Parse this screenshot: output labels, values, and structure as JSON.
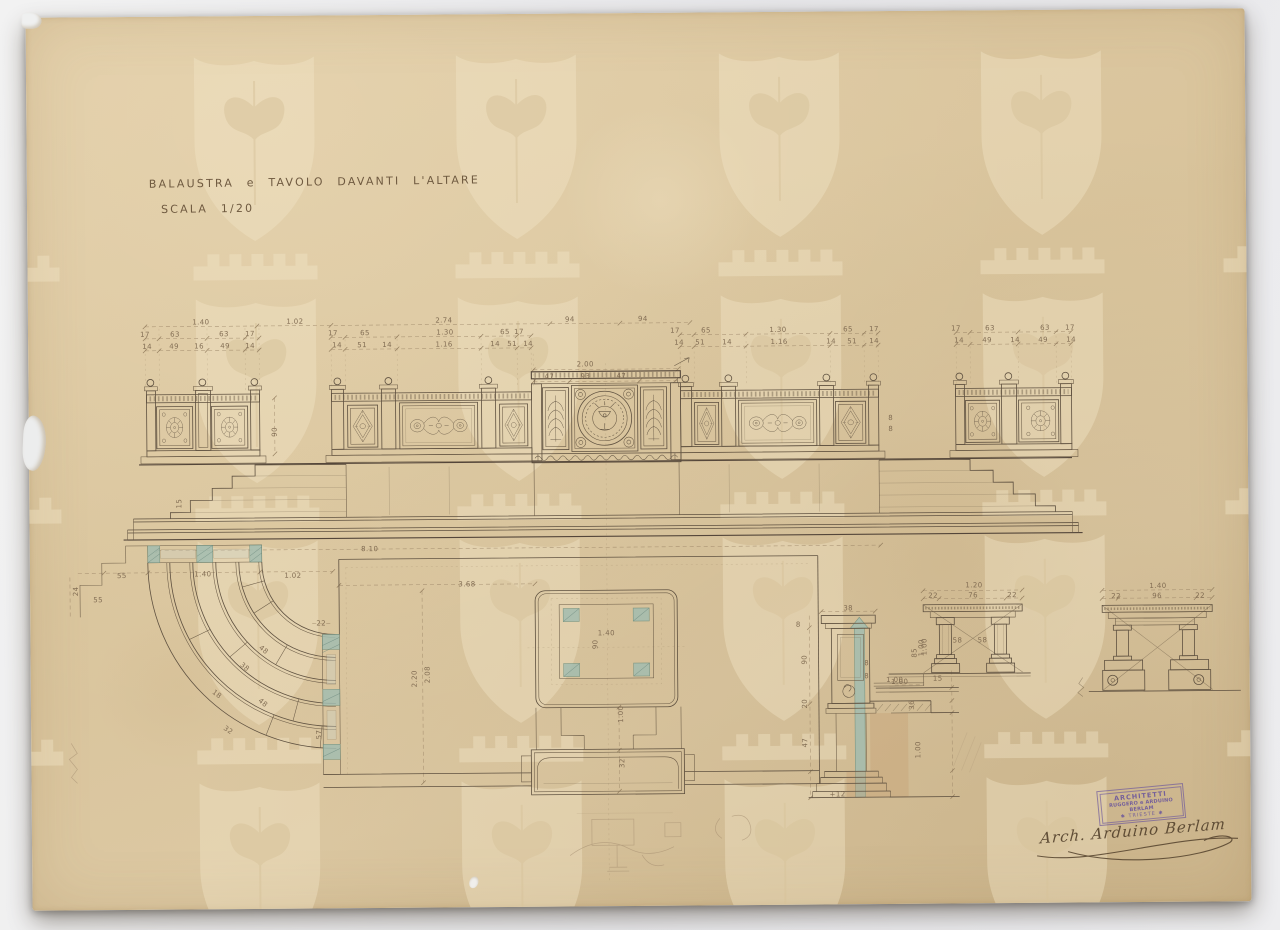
{
  "document": {
    "title": "BALAUSTRA e TAVOLO DAVANTI L'ALTARE",
    "scale": "SCALA 1/20"
  },
  "stamp": {
    "line1": "ARCHITETTI",
    "line2": "RUGGERO e ARDUINO BERLAM",
    "line3": "✱ TRIESTE ✱"
  },
  "signature": "Arch. Arduino Berlam",
  "colors": {
    "paper": "#dcc8a2",
    "ink": "#5f5140",
    "dimension_ink": "#8a735a",
    "verdigris": "#a3bdb0",
    "wash_brown": "#c3996b",
    "stamp_purple": "#6d589c",
    "backdrop": "#e9e9ec"
  },
  "annotations": [
    {
      "t": "1.40",
      "x": 173,
      "y": 306
    },
    {
      "t": "1.02",
      "x": 267,
      "y": 306
    },
    {
      "t": "2.74",
      "x": 416,
      "y": 306
    },
    {
      "t": "94",
      "x": 542,
      "y": 306
    },
    {
      "t": "94",
      "x": 615,
      "y": 306
    },
    {
      "t": "17",
      "x": 117,
      "y": 318
    },
    {
      "t": "63",
      "x": 147,
      "y": 318
    },
    {
      "t": "63",
      "x": 196,
      "y": 318
    },
    {
      "t": "17",
      "x": 222,
      "y": 318
    },
    {
      "t": "17",
      "x": 305,
      "y": 318
    },
    {
      "t": "65",
      "x": 337,
      "y": 318
    },
    {
      "t": "1.30",
      "x": 417,
      "y": 318
    },
    {
      "t": "65",
      "x": 477,
      "y": 318
    },
    {
      "t": "17",
      "x": 491,
      "y": 318
    },
    {
      "t": "17",
      "x": 647,
      "y": 318
    },
    {
      "t": "65",
      "x": 678,
      "y": 318
    },
    {
      "t": "1.30",
      "x": 750,
      "y": 318
    },
    {
      "t": "65",
      "x": 820,
      "y": 318
    },
    {
      "t": "17",
      "x": 846,
      "y": 318
    },
    {
      "t": "17",
      "x": 928,
      "y": 318
    },
    {
      "t": "63",
      "x": 962,
      "y": 318
    },
    {
      "t": "63",
      "x": 1017,
      "y": 318
    },
    {
      "t": "17",
      "x": 1042,
      "y": 318
    },
    {
      "t": "14",
      "x": 119,
      "y": 330
    },
    {
      "t": "49",
      "x": 146,
      "y": 330
    },
    {
      "t": "16",
      "x": 171,
      "y": 330
    },
    {
      "t": "49",
      "x": 197,
      "y": 330
    },
    {
      "t": "14",
      "x": 222,
      "y": 330
    },
    {
      "t": "14",
      "x": 309,
      "y": 330
    },
    {
      "t": "51",
      "x": 334,
      "y": 330
    },
    {
      "t": "14",
      "x": 359,
      "y": 330
    },
    {
      "t": "1.16",
      "x": 416,
      "y": 330
    },
    {
      "t": "14",
      "x": 467,
      "y": 330
    },
    {
      "t": "51",
      "x": 484,
      "y": 330
    },
    {
      "t": "14",
      "x": 500,
      "y": 330
    },
    {
      "t": "14",
      "x": 651,
      "y": 330
    },
    {
      "t": "51",
      "x": 672,
      "y": 330
    },
    {
      "t": "14",
      "x": 699,
      "y": 330
    },
    {
      "t": "1.16",
      "x": 751,
      "y": 330
    },
    {
      "t": "14",
      "x": 803,
      "y": 330
    },
    {
      "t": "51",
      "x": 824,
      "y": 330
    },
    {
      "t": "14",
      "x": 846,
      "y": 330
    },
    {
      "t": "14",
      "x": 931,
      "y": 330
    },
    {
      "t": "49",
      "x": 959,
      "y": 330
    },
    {
      "t": "14",
      "x": 987,
      "y": 330
    },
    {
      "t": "49",
      "x": 1015,
      "y": 330
    },
    {
      "t": "14",
      "x": 1043,
      "y": 330
    },
    {
      "t": "2.00",
      "x": 557,
      "y": 351
    },
    {
      "t": "47",
      "x": 521,
      "y": 363
    },
    {
      "t": "93",
      "x": 557,
      "y": 363
    },
    {
      "t": "47",
      "x": 593,
      "y": 363
    },
    {
      "t": "90",
      "x": 246,
      "y": 416,
      "r": -90
    },
    {
      "t": "8",
      "x": 862,
      "y": 407
    },
    {
      "t": "8",
      "x": 862,
      "y": 418
    },
    {
      "t": "15",
      "x": 150,
      "y": 487,
      "r": -90
    },
    {
      "t": "8.10",
      "x": 340,
      "y": 534
    },
    {
      "t": "55",
      "x": 92,
      "y": 559
    },
    {
      "t": "55",
      "x": 68,
      "y": 583
    },
    {
      "t": "24",
      "x": 46,
      "y": 574,
      "r": -90
    },
    {
      "t": "1.40",
      "x": 173,
      "y": 558
    },
    {
      "t": "1.02",
      "x": 263,
      "y": 560
    },
    {
      "t": "22",
      "x": 291,
      "y": 608
    },
    {
      "t": "48",
      "x": 233,
      "y": 634,
      "r": 40
    },
    {
      "t": "38",
      "x": 214,
      "y": 651,
      "r": 40
    },
    {
      "t": "18",
      "x": 186,
      "y": 678,
      "r": 38
    },
    {
      "t": "32",
      "x": 197,
      "y": 714,
      "r": 35
    },
    {
      "t": "48",
      "x": 232,
      "y": 687,
      "r": 40
    },
    {
      "t": "57",
      "x": 288,
      "y": 719,
      "r": -90
    },
    {
      "t": "3.68",
      "x": 437,
      "y": 570
    },
    {
      "t": "2.20",
      "x": 384,
      "y": 664,
      "r": -90
    },
    {
      "t": "2.08",
      "x": 397,
      "y": 660,
      "r": -90
    },
    {
      "t": "1.40",
      "x": 576,
      "y": 620
    },
    {
      "t": "90",
      "x": 565,
      "y": 631,
      "r": -90
    },
    {
      "t": "1.00",
      "x": 590,
      "y": 701,
      "r": -90
    },
    {
      "t": "32",
      "x": 591,
      "y": 750,
      "r": -90
    },
    {
      "t": "38",
      "x": 818,
      "y": 597
    },
    {
      "t": "8",
      "x": 768,
      "y": 613
    },
    {
      "t": "90",
      "x": 774,
      "y": 648,
      "r": -90
    },
    {
      "t": "20",
      "x": 774,
      "y": 692,
      "r": -90
    },
    {
      "t": "47",
      "x": 774,
      "y": 731,
      "r": -90
    },
    {
      "t": "8",
      "x": 836,
      "y": 652
    },
    {
      "t": "8",
      "x": 836,
      "y": 665
    },
    {
      "t": "1.00",
      "x": 869,
      "y": 671
    },
    {
      "t": "36",
      "x": 881,
      "y": 694,
      "r": -90
    },
    {
      "t": "1.00",
      "x": 891,
      "y": 637,
      "r": -90
    },
    {
      "t": "1.00",
      "x": 887,
      "y": 739,
      "r": -90
    },
    {
      "t": "+12",
      "x": 806,
      "y": 783
    },
    {
      "t": "1.20",
      "x": 944,
      "y": 575
    },
    {
      "t": "22",
      "x": 903,
      "y": 585
    },
    {
      "t": "76",
      "x": 943,
      "y": 585
    },
    {
      "t": "22",
      "x": 982,
      "y": 585
    },
    {
      "t": "58",
      "x": 927,
      "y": 630
    },
    {
      "t": "58",
      "x": 952,
      "y": 630
    },
    {
      "t": "85",
      "x": 884,
      "y": 642,
      "r": -90
    },
    {
      "t": "1.00",
      "x": 894,
      "y": 636,
      "r": -90
    },
    {
      "t": "1.00",
      "x": 864,
      "y": 669
    },
    {
      "t": "15",
      "x": 907,
      "y": 668
    },
    {
      "t": "1.40",
      "x": 1128,
      "y": 577
    },
    {
      "t": "22",
      "x": 1086,
      "y": 587
    },
    {
      "t": "96",
      "x": 1127,
      "y": 587
    },
    {
      "t": "22",
      "x": 1170,
      "y": 587
    }
  ]
}
